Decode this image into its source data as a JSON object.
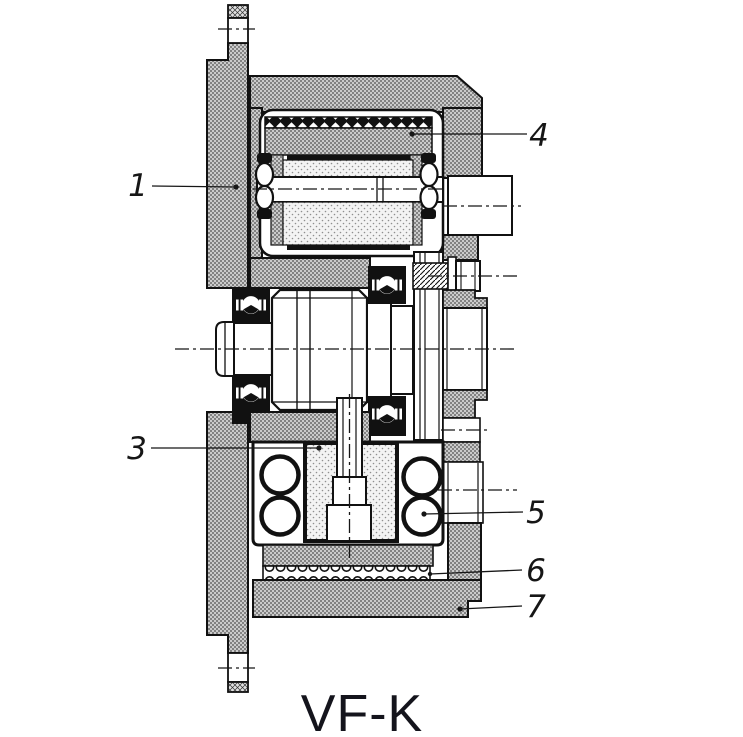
{
  "diagram": {
    "caption": "VF-K",
    "callouts": [
      {
        "num": "1"
      },
      {
        "num": "3"
      },
      {
        "num": "4"
      },
      {
        "num": "5"
      },
      {
        "num": "6"
      },
      {
        "num": "7"
      }
    ]
  },
  "colors": {
    "ink": "#161616",
    "paper": "#ffffff",
    "section_fill_gray": "#cccccc",
    "stipple_gray": "#f3f3f3"
  }
}
